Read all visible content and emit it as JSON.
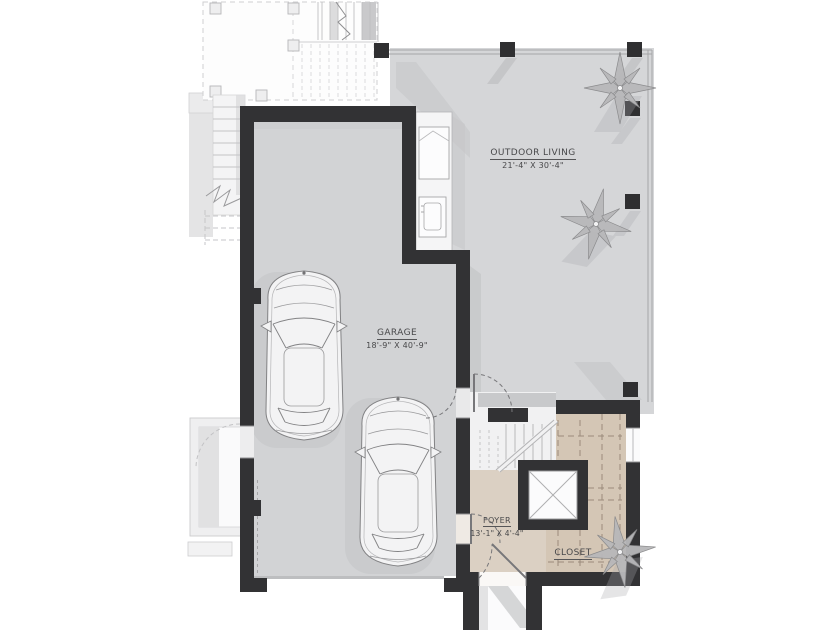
{
  "plan": {
    "type": "architectural-floor-plan",
    "rooms": {
      "outdoor_living": {
        "name": "OUTDOOR LIVING",
        "dims": "21'-4\" X 30'-4\""
      },
      "garage": {
        "name": "GARAGE",
        "dims": "18'-9\" X 40'-9\""
      },
      "foyer": {
        "name": "FOYER",
        "dims": "13'-1\" X 4'-4\""
      },
      "closet": {
        "name": "CLOSET"
      }
    },
    "features": [
      "two-cars-top-view",
      "elevator-shaft",
      "stairs",
      "entry-porch",
      "deck-above",
      "ornamental-plants"
    ],
    "colors": {
      "background": "#ffffff",
      "wall": "#323234",
      "floor_gray": "#d4d5d7",
      "floor_tan": "#dbd0c3",
      "faint_line": "#c6c6c8",
      "text": "#48484a"
    }
  }
}
